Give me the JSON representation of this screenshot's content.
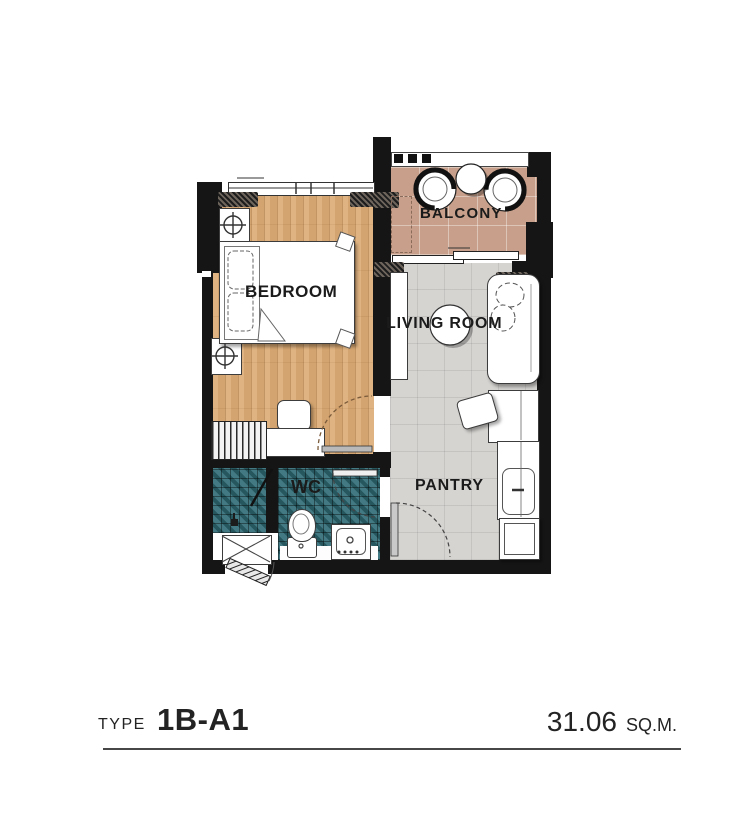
{
  "rooms": {
    "bedroom": {
      "label": "BEDROOM"
    },
    "balcony": {
      "label": "BALCONY"
    },
    "living": {
      "label": "LIVING ROOM"
    },
    "wc": {
      "label": "WC"
    },
    "pantry": {
      "label": "PANTRY"
    }
  },
  "caption": {
    "type_label": "TYPE",
    "type_value": "1B-A1",
    "area_value": "31.06",
    "area_unit": "SQ.M."
  },
  "colors": {
    "wall": "#151515",
    "wood": "#dcab74",
    "tile_teal": "#2e6a74",
    "balcony_tile": "#c79f8a",
    "floor_gray": "#d6d4d1",
    "label": "#1b1b1b"
  }
}
